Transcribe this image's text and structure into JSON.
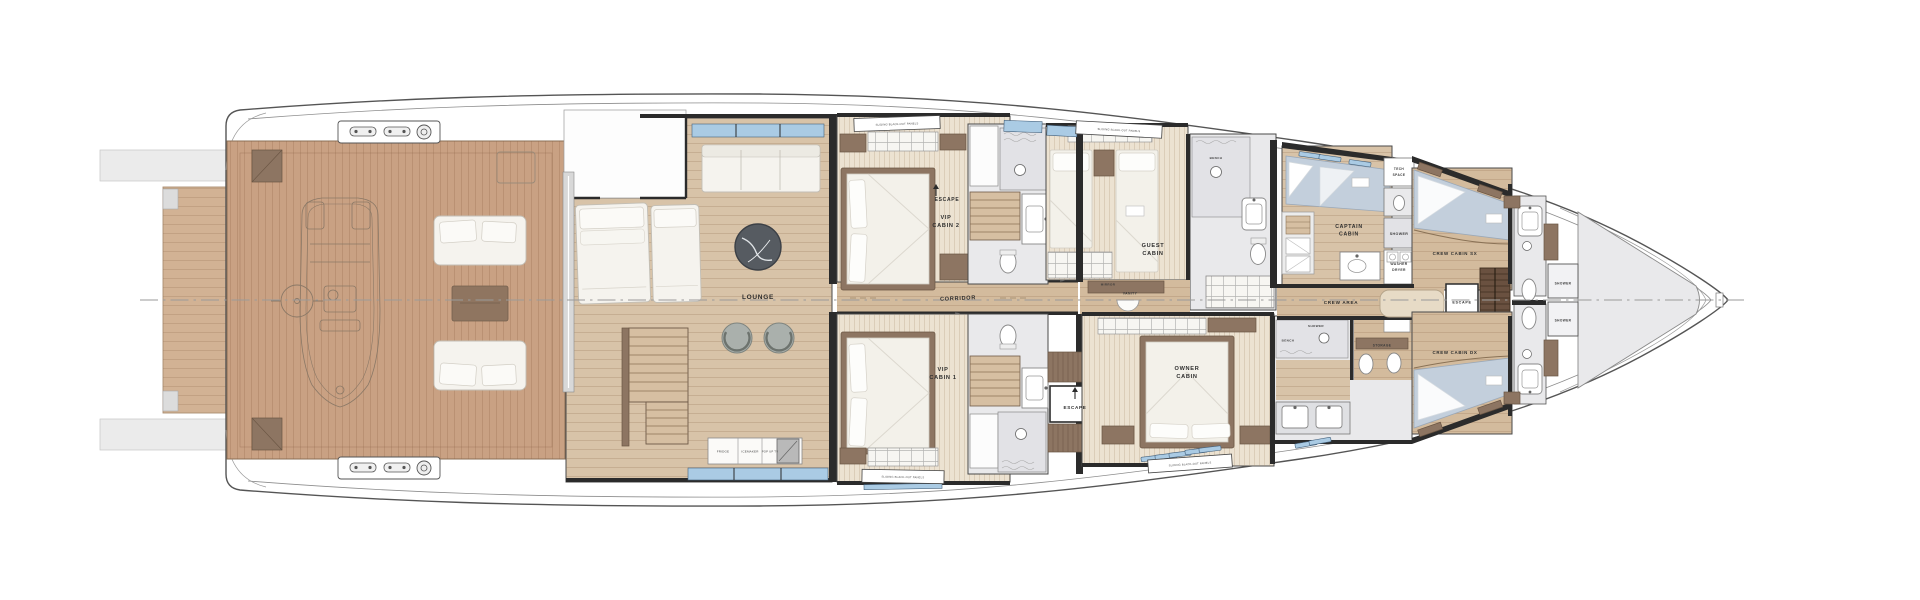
{
  "diagram_type": "yacht-lower-deck-floor-plan",
  "colors": {
    "deck_wood": "#c9a183",
    "platform_wood": "#d2b294",
    "lounge_wood": "#d8c3a8",
    "corridor_wood": "#d3bb9d",
    "cabin_carpet": "#ece2d1",
    "marble": "#e9e9eb",
    "wall_dark": "#2b2b2b",
    "furniture_brown": "#8d7562",
    "furniture_white": "#f5f3ee",
    "bed_white": "#f3f1ea",
    "crew_bed_blue": "#c3cfdc",
    "window_blue": "#aacbe4",
    "stairs_dark": "#6a5140",
    "table_marble": "#565b61"
  },
  "labels": {
    "lounge": "LOUNGE",
    "corridor": "CORRIDOR",
    "escape": "ESCAPE",
    "vip2_l1": "VIP",
    "vip2_l2": "CABIN 2",
    "vip1_l1": "VIP",
    "vip1_l2": "CABIN 1",
    "guest_l1": "GUEST",
    "guest_l2": "CABIN",
    "owner_l1": "OWNER",
    "owner_l2": "CABIN",
    "captain_l1": "CAPTAIN",
    "captain_l2": "CABIN",
    "crew_sx": "CREW CABIN SX",
    "crew_dx": "CREW CABIN DX",
    "crew_area": "CREW AREA",
    "shower": "SHOWER",
    "washer_l1": "WASHER",
    "washer_l2": "DRYER",
    "tech_l1": "TECH",
    "tech_l2": "SPACE",
    "storage": "STORAGE",
    "bench": "BENCH",
    "mirror": "MIRROR",
    "vanity": "VANITY",
    "fridge": "FRIDGE",
    "icemaker": "ICEMAKER",
    "pop_up_tv": "POP UP TV",
    "blackout_panels": "SLIDING BLACK-OUT PANELS"
  }
}
